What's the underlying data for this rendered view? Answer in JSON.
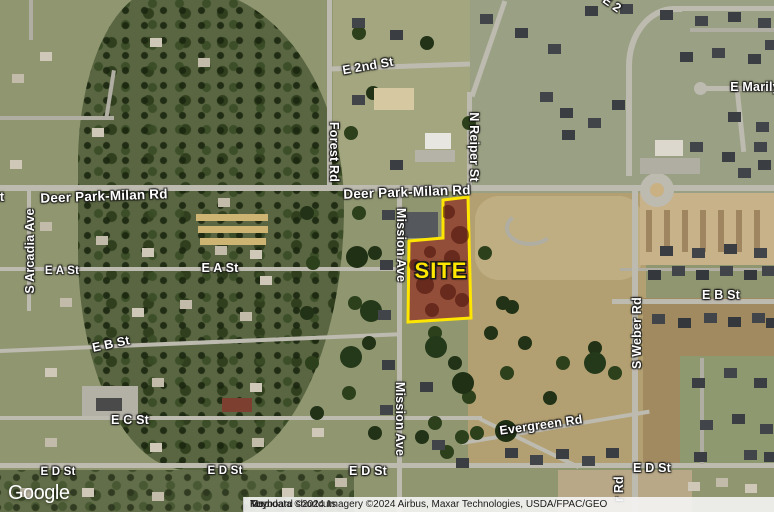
{
  "map": {
    "type": "satellite",
    "labels": {
      "e2nd_st": "E 2nd St",
      "e2_partial": "E 2",
      "forest_rd": "Forest Rd",
      "n_reiper_st": "N Reiper St",
      "deer_park_left": "Deer Park-Milan Rd",
      "deer_park_center": "Deer Park-Milan Rd",
      "left_edge_partial": "t",
      "s_arcadia_ave": "S Arcadia Ave",
      "e_a_st_left": "E A St",
      "e_a_st_center": "E A St",
      "mission_ave_upper": "Mission Ave",
      "mission_ave_lower": "Mission Ave",
      "e_b_st_left": "E B St",
      "e_b_st_right": "E B St",
      "s_weber_rd": "S Weber Rd",
      "weber_rd_partial": "r Rd",
      "e_marilyn_partial": "E Marily",
      "e_c_st": "E C St",
      "evergreen_rd": "Evergreen Rd",
      "e_d_st_left": "E D St",
      "e_d_st_center_left": "E D St",
      "e_d_st_center": "E D St",
      "e_d_st_right": "E D St"
    },
    "site_overlay": {
      "label": "SITE",
      "fill_color": "#94221 7",
      "outline_color": "#FFE600",
      "label_color": "#FFE600"
    }
  },
  "branding": {
    "logo": "Google"
  },
  "attribution": {
    "keyboard_shortcuts": "Keyboard shortcuts",
    "map_data": "Map data ©2024 Imagery ©2024 Airbus, Maxar Technologies, USDA/FPAC/GEO",
    "terms": "Term"
  }
}
